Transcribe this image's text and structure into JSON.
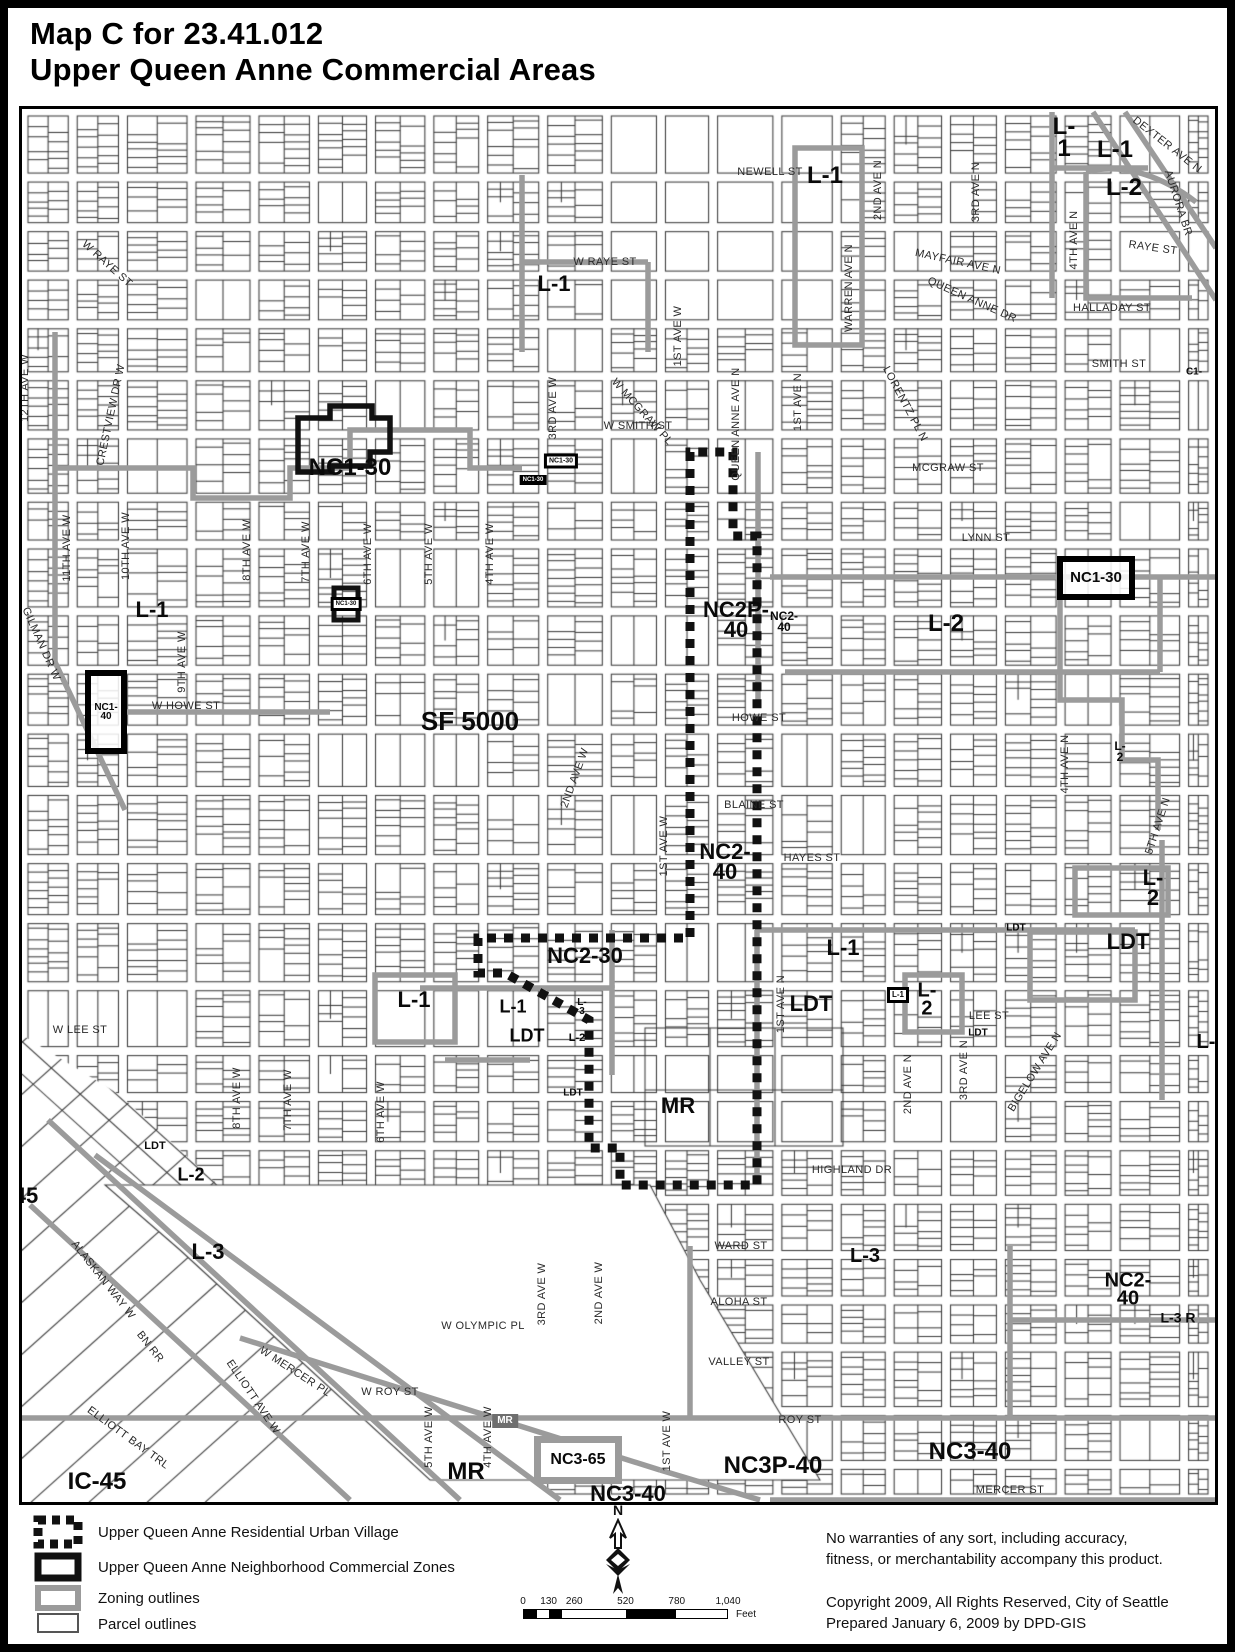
{
  "title": {
    "line1": "Map C for 23.41.012",
    "line2": "Upper Queen Anne Commercial Areas"
  },
  "map": {
    "zone_labels": [
      {
        "text": "L-1",
        "x": 825,
        "y": 176,
        "fs": 24
      },
      {
        "text": "L-\n1",
        "x": 1064,
        "y": 138,
        "fs": 24
      },
      {
        "text": "L-1",
        "x": 1115,
        "y": 150,
        "fs": 24
      },
      {
        "text": "L-2",
        "x": 1124,
        "y": 188,
        "fs": 24
      },
      {
        "text": "L-1",
        "x": 554,
        "y": 284,
        "fs": 22
      },
      {
        "text": "NC1-30",
        "x": 350,
        "y": 468,
        "fs": 24
      },
      {
        "text": "NC1-30",
        "x": 561,
        "y": 461,
        "fs": 7,
        "box": "tinyoutline"
      },
      {
        "text": "NC1-30",
        "x": 533,
        "y": 480,
        "fs": 6,
        "box": "tinyfill"
      },
      {
        "text": "NC1-30",
        "x": 346,
        "y": 604,
        "fs": 6,
        "box": "tinyoutline"
      },
      {
        "text": "L-1",
        "x": 152,
        "y": 610,
        "fs": 22
      },
      {
        "text": "NC1-\n40",
        "x": 106,
        "y": 712,
        "fs": 10,
        "box": "heavy",
        "w": 30,
        "h": 72
      },
      {
        "text": "SF 5000",
        "x": 470,
        "y": 722,
        "fs": 26
      },
      {
        "text": "NC2P-\n40",
        "x": 736,
        "y": 620,
        "fs": 22
      },
      {
        "text": "NC2-\n40",
        "x": 784,
        "y": 622,
        "fs": 12
      },
      {
        "text": "L-2",
        "x": 946,
        "y": 624,
        "fs": 24
      },
      {
        "text": "NC1-30",
        "x": 1096,
        "y": 578,
        "fs": 15,
        "box": "heavy",
        "w": 66,
        "h": 32
      },
      {
        "text": "L-\n2",
        "x": 1120,
        "y": 752,
        "fs": 12
      },
      {
        "text": "NC2-\n40",
        "x": 725,
        "y": 862,
        "fs": 22
      },
      {
        "text": "L-\n2",
        "x": 1153,
        "y": 888,
        "fs": 22
      },
      {
        "text": "LDT",
        "x": 1128,
        "y": 942,
        "fs": 22
      },
      {
        "text": "LDT",
        "x": 1016,
        "y": 928,
        "fs": 10
      },
      {
        "text": "NC2-30",
        "x": 585,
        "y": 956,
        "fs": 22
      },
      {
        "text": "L-1",
        "x": 843,
        "y": 948,
        "fs": 22
      },
      {
        "text": "L-1",
        "x": 414,
        "y": 1000,
        "fs": 22
      },
      {
        "text": "L-1",
        "x": 513,
        "y": 1007,
        "fs": 18
      },
      {
        "text": "L-\n3",
        "x": 582,
        "y": 1007,
        "fs": 10
      },
      {
        "text": "LDT",
        "x": 527,
        "y": 1036,
        "fs": 18
      },
      {
        "text": "L-2",
        "x": 577,
        "y": 1038,
        "fs": 11
      },
      {
        "text": "LDT",
        "x": 811,
        "y": 1004,
        "fs": 22
      },
      {
        "text": "L-1",
        "x": 898,
        "y": 995,
        "fs": 8,
        "box": "tinyoutline"
      },
      {
        "text": "L-\n2",
        "x": 927,
        "y": 1000,
        "fs": 20
      },
      {
        "text": "LDT",
        "x": 978,
        "y": 1033,
        "fs": 10
      },
      {
        "text": "MR",
        "x": 678,
        "y": 1106,
        "fs": 22
      },
      {
        "text": "LDT",
        "x": 573,
        "y": 1093,
        "fs": 10
      },
      {
        "text": "L-",
        "x": 1206,
        "y": 1042,
        "fs": 20
      },
      {
        "text": "LDT",
        "x": 155,
        "y": 1146,
        "fs": 11
      },
      {
        "text": "L-2",
        "x": 191,
        "y": 1175,
        "fs": 18
      },
      {
        "text": "45",
        "x": 26,
        "y": 1196,
        "fs": 22
      },
      {
        "text": "L-3",
        "x": 208,
        "y": 1252,
        "fs": 22
      },
      {
        "text": "L-3",
        "x": 865,
        "y": 1256,
        "fs": 20
      },
      {
        "text": "NC2-\n40",
        "x": 1128,
        "y": 1290,
        "fs": 20
      },
      {
        "text": "L-3 R",
        "x": 1178,
        "y": 1318,
        "fs": 14
      },
      {
        "text": "MR",
        "x": 505,
        "y": 1421,
        "fs": 10,
        "box": "grayfill"
      },
      {
        "text": "MR",
        "x": 466,
        "y": 1472,
        "fs": 24
      },
      {
        "text": "NC3-65",
        "x": 578,
        "y": 1460,
        "fs": 16,
        "box": "grayheavy",
        "w": 74,
        "h": 34
      },
      {
        "text": "NC3-40",
        "x": 628,
        "y": 1494,
        "fs": 22
      },
      {
        "text": "NC3P-40",
        "x": 773,
        "y": 1466,
        "fs": 24
      },
      {
        "text": "NC3-40",
        "x": 970,
        "y": 1452,
        "fs": 24
      },
      {
        "text": "IC-45",
        "x": 97,
        "y": 1482,
        "fs": 24
      },
      {
        "text": "C1-",
        "x": 1194,
        "y": 372,
        "fs": 10
      }
    ],
    "street_labels": [
      {
        "text": "NEWELL ST",
        "x": 770,
        "y": 172,
        "rot": 0
      },
      {
        "text": "W RAYE ST",
        "x": 107,
        "y": 264,
        "rot": 42
      },
      {
        "text": "W RAYE ST",
        "x": 605,
        "y": 262,
        "rot": 0
      },
      {
        "text": "RAYE ST",
        "x": 1153,
        "y": 248,
        "rot": 8
      },
      {
        "text": "DEXTER AVE N",
        "x": 1167,
        "y": 145,
        "rot": 38
      },
      {
        "text": "AURORA BR",
        "x": 1178,
        "y": 203,
        "rot": 72
      },
      {
        "text": "2ND AVE N",
        "x": 878,
        "y": 190,
        "rot": -90
      },
      {
        "text": "3RD AVE N",
        "x": 976,
        "y": 192,
        "rot": -90
      },
      {
        "text": "WARREN AVE N",
        "x": 849,
        "y": 288,
        "rot": -90
      },
      {
        "text": "MAYFAIR AVE N",
        "x": 958,
        "y": 262,
        "rot": 12
      },
      {
        "text": "QUEEN ANNE DR",
        "x": 972,
        "y": 300,
        "rot": 24
      },
      {
        "text": "4TH AVE N",
        "x": 1074,
        "y": 240,
        "rot": -90
      },
      {
        "text": "HALLADAY ST",
        "x": 1112,
        "y": 308,
        "rot": 0
      },
      {
        "text": "SMITH ST",
        "x": 1119,
        "y": 364,
        "rot": 0
      },
      {
        "text": "W SMITH ST",
        "x": 638,
        "y": 426,
        "rot": 0
      },
      {
        "text": "1ST AVE W",
        "x": 678,
        "y": 336,
        "rot": -90
      },
      {
        "text": "CRESTVIEW DR W",
        "x": 111,
        "y": 415,
        "rot": -78
      },
      {
        "text": "12TH AVE W",
        "x": 25,
        "y": 388,
        "rot": -90
      },
      {
        "text": "W MCGRAW PL",
        "x": 642,
        "y": 412,
        "rot": 48
      },
      {
        "text": "QUEEN ANNE AVE N",
        "x": 736,
        "y": 424,
        "rot": -90
      },
      {
        "text": "1ST AVE N",
        "x": 798,
        "y": 402,
        "rot": -90
      },
      {
        "text": "LORENTZ PL N",
        "x": 905,
        "y": 404,
        "rot": 62
      },
      {
        "text": "MCGRAW ST",
        "x": 948,
        "y": 468,
        "rot": 0
      },
      {
        "text": "LYNN ST",
        "x": 986,
        "y": 538,
        "rot": 0
      },
      {
        "text": "GILMAN DR W",
        "x": 41,
        "y": 644,
        "rot": 66
      },
      {
        "text": "11TH AVE W",
        "x": 67,
        "y": 548,
        "rot": -90
      },
      {
        "text": "10TH AVE W",
        "x": 126,
        "y": 546,
        "rot": -90
      },
      {
        "text": "9TH AVE W",
        "x": 182,
        "y": 662,
        "rot": -90
      },
      {
        "text": "8TH AVE W",
        "x": 247,
        "y": 550,
        "rot": -90
      },
      {
        "text": "7TH AVE W",
        "x": 306,
        "y": 552,
        "rot": -90
      },
      {
        "text": "6TH AVE W",
        "x": 368,
        "y": 554,
        "rot": -90
      },
      {
        "text": "5TH AVE W",
        "x": 429,
        "y": 554,
        "rot": -90
      },
      {
        "text": "4TH AVE W",
        "x": 490,
        "y": 554,
        "rot": -90
      },
      {
        "text": "3RD AVE W",
        "x": 553,
        "y": 408,
        "rot": -90
      },
      {
        "text": "W HOWE ST",
        "x": 186,
        "y": 706,
        "rot": 0
      },
      {
        "text": "HOWE ST",
        "x": 759,
        "y": 718,
        "rot": 0
      },
      {
        "text": "2ND AVE W",
        "x": 575,
        "y": 778,
        "rot": -70
      },
      {
        "text": "BLAINE ST",
        "x": 754,
        "y": 805,
        "rot": 0
      },
      {
        "text": "1ST AVE W",
        "x": 664,
        "y": 846,
        "rot": -90
      },
      {
        "text": "HAYES ST",
        "x": 812,
        "y": 858,
        "rot": 0
      },
      {
        "text": "1ST AVE N",
        "x": 781,
        "y": 1004,
        "rot": -90
      },
      {
        "text": "LEE ST",
        "x": 989,
        "y": 1016,
        "rot": 0
      },
      {
        "text": "W LEE ST",
        "x": 80,
        "y": 1030,
        "rot": 0
      },
      {
        "text": "2ND AVE N",
        "x": 908,
        "y": 1084,
        "rot": -90
      },
      {
        "text": "3RD AVE N",
        "x": 964,
        "y": 1070,
        "rot": -90
      },
      {
        "text": "BIGELOW AVE N",
        "x": 1035,
        "y": 1072,
        "rot": -58
      },
      {
        "text": "4TH AVE N",
        "x": 1065,
        "y": 764,
        "rot": -90
      },
      {
        "text": "5TH AVE N",
        "x": 1158,
        "y": 826,
        "rot": -72
      },
      {
        "text": "HIGHLAND DR",
        "x": 852,
        "y": 1170,
        "rot": 0
      },
      {
        "text": "6TH AVE W",
        "x": 381,
        "y": 1112,
        "rot": -90
      },
      {
        "text": "7TH AVE W",
        "x": 288,
        "y": 1100,
        "rot": -90
      },
      {
        "text": "8TH AVE W",
        "x": 237,
        "y": 1098,
        "rot": -90
      },
      {
        "text": "WARD ST",
        "x": 741,
        "y": 1246,
        "rot": 0
      },
      {
        "text": "ALOHA ST",
        "x": 739,
        "y": 1302,
        "rot": 0
      },
      {
        "text": "VALLEY ST",
        "x": 739,
        "y": 1362,
        "rot": 0
      },
      {
        "text": "W OLYMPIC PL",
        "x": 483,
        "y": 1326,
        "rot": 0
      },
      {
        "text": "W ROY ST",
        "x": 390,
        "y": 1392,
        "rot": 0
      },
      {
        "text": "ROY ST",
        "x": 800,
        "y": 1420,
        "rot": 0
      },
      {
        "text": "3RD AVE W",
        "x": 542,
        "y": 1294,
        "rot": -90
      },
      {
        "text": "2ND AVE W",
        "x": 599,
        "y": 1293,
        "rot": -90
      },
      {
        "text": "5TH AVE W",
        "x": 429,
        "y": 1437,
        "rot": -90
      },
      {
        "text": "4TH AVE W",
        "x": 488,
        "y": 1437,
        "rot": -90
      },
      {
        "text": "1ST AVE W",
        "x": 667,
        "y": 1441,
        "rot": -90
      },
      {
        "text": "MERCER ST",
        "x": 1010,
        "y": 1490,
        "rot": 0
      },
      {
        "text": "ALASKAN WAY W",
        "x": 103,
        "y": 1280,
        "rot": 52
      },
      {
        "text": "BN RR",
        "x": 150,
        "y": 1347,
        "rot": 52
      },
      {
        "text": "ELLIOTT BAY TRL",
        "x": 128,
        "y": 1438,
        "rot": 36
      },
      {
        "text": "W MERCER PL",
        "x": 295,
        "y": 1372,
        "rot": 33
      },
      {
        "text": "ELLIOTT AVE W",
        "x": 253,
        "y": 1397,
        "rot": 56
      }
    ]
  },
  "legend": {
    "items": [
      {
        "swatch": "urban-village",
        "label": "Upper Queen Anne Residential Urban Village"
      },
      {
        "swatch": "commercial-zones",
        "label": "Upper Queen Anne Neighborhood Commercial Zones"
      },
      {
        "swatch": "zoning-outlines",
        "label": "Zoning outlines"
      },
      {
        "swatch": "parcel-outlines",
        "label": "Parcel outlines"
      }
    ]
  },
  "compass": {
    "label": "N"
  },
  "scalebar": {
    "ticks": [
      "0",
      "130",
      "260",
      "520",
      "780",
      "1,040"
    ],
    "tick_fractions": [
      0,
      0.125,
      0.25,
      0.5,
      0.75,
      1
    ],
    "unit": "Feet"
  },
  "notes": {
    "disclaimer": [
      "No warranties of any sort, including accuracy,",
      "fitness, or merchantability accompany this product."
    ],
    "copyright": [
      "Copyright 2009, All Rights Reserved, City of Seattle",
      "Prepared January 6, 2009  by DPD-GIS"
    ]
  },
  "colors": {
    "ink": "#111111",
    "zoning": "#9b9b9b",
    "parcel": "#3b3b3b"
  }
}
